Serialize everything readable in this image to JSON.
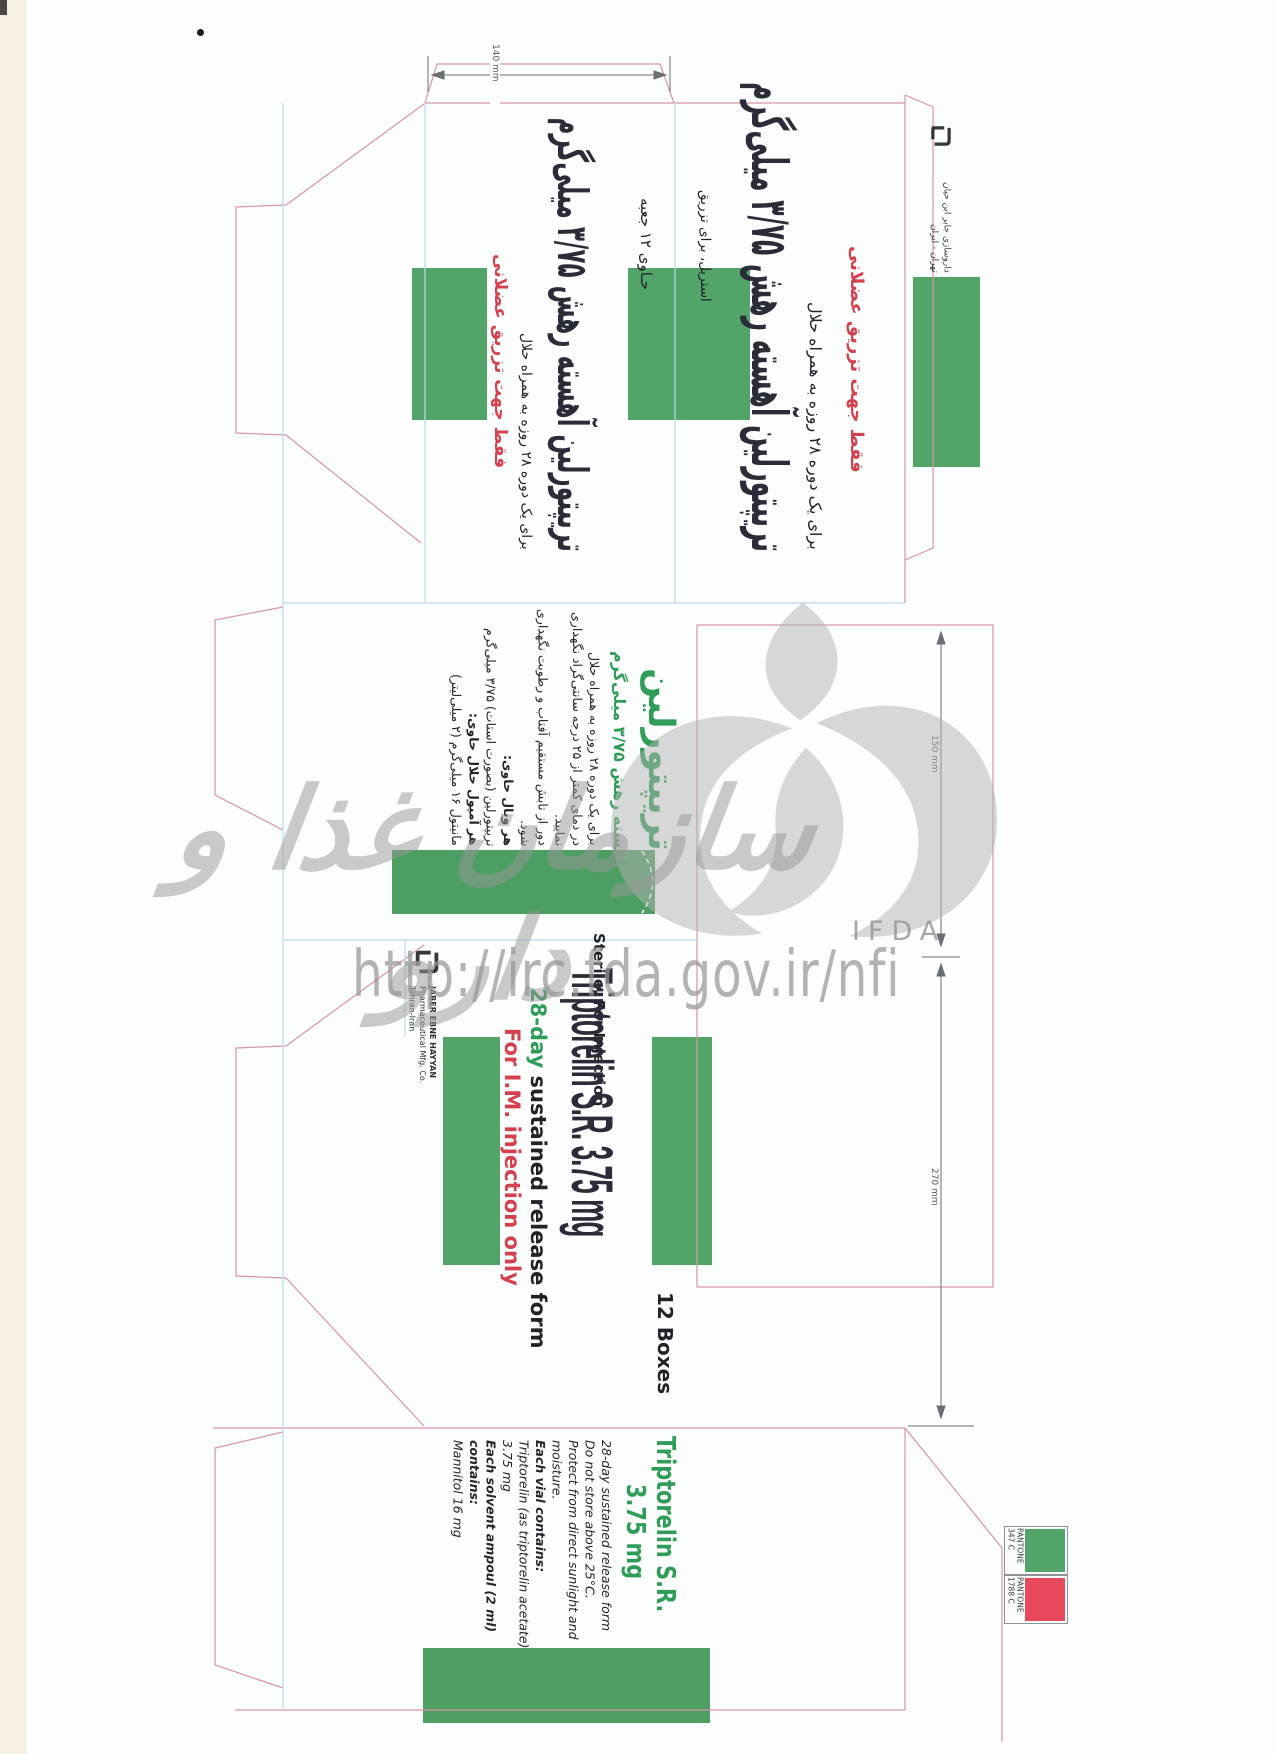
{
  "dimensions": {
    "width": "140 mm",
    "height": "150 mm",
    "depth": "270 mm"
  },
  "watermarks": {
    "org_fa": "سازمان غذا و دارو",
    "org_en": "IFDA",
    "url": "http://irc.fda.gov.ir/nfi"
  },
  "pantone": {
    "green": {
      "brand": "PANTONE",
      "code": "347 C",
      "color": "#53a468"
    },
    "red": {
      "brand": "PANTONE",
      "code": "1788 C",
      "color": "#e8495c"
    }
  },
  "company_en": {
    "name": "JABER EBNE HAYYAN",
    "line2": "Pharmaceutical Mfg. Co.",
    "line3": "Tehran-Iran"
  },
  "company_fa": {
    "name": "داروسازی جابر ابن حیان",
    "city": "تهران - ایران"
  },
  "fa": {
    "side": {
      "contains": "حـاوی ۱۲ جعبه",
      "title": "تریپتورلین آهسته رهش ۳/۷۵ میلی‌گرم",
      "period": "برای یک دوره ۲۸ روزه به همراه حلال",
      "im_only": "فقط جهت تزریق عضلانی"
    },
    "front": {
      "sterile": "استریل، برای تزریق",
      "title": "تریپتورلین آهسته رهش ۳/۷۵ میلی‌گرم",
      "period": "برای یک دوره ۲۸ روزه به همراه حلال",
      "im_only": "فقط جهت تزریق عضلانی"
    },
    "back": {
      "brand": "تریپتورلین",
      "strength": "آهسته رهش ۳/۷۵ میلی‌گرم",
      "lines": [
        "برای یک دوره ۲۸ روزه به همراه حلال",
        "در دمای کمتر از ۲۵ درجه سانتی‌گراد نگهداری",
        "نمایید.",
        "دور از تابش مستقیم آفتاب و رطوبت نگهداری",
        "شود.",
        "هر ویال حاوی:",
        "تریپتورلین (بصورت استات) ۳/۷۵ میلی‌گرم",
        "هر آمپول حلال حاوی:",
        "مانیتول ۱۶ میلی‌گرم (۲ میلی‌لیتر)"
      ]
    }
  },
  "en": {
    "front": {
      "sterile": "Sterile, For Injection",
      "title": "Triptorelin S.R. 3.75 mg",
      "sub_green": "28-day",
      "sub_rest": " sustained release form",
      "im_only": "For I.M. injection only",
      "count": "12 Boxes"
    },
    "back": {
      "brand": "Triptorelin S.R.",
      "strength": "3.75 mg",
      "lines": [
        "28-day sustained release form",
        "Do not store above 25°C.",
        "Protect from direct sunlight and",
        "moisture.",
        "Each vial contains:",
        "Triptorelin (as triptorelin acetate)",
        "3.75 mg",
        "Each solvent ampoul (2 ml)",
        "contains:",
        "Mannitol 16 mg"
      ]
    }
  }
}
